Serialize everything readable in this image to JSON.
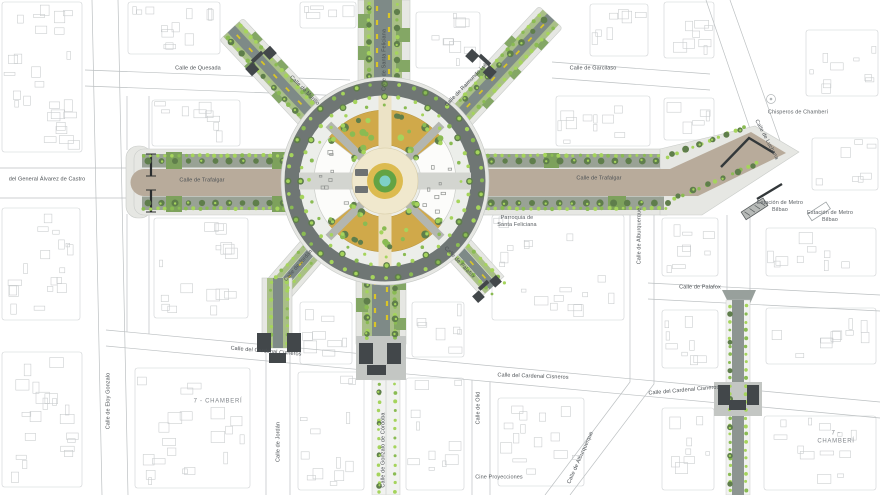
{
  "labels": {
    "quesada": "Calle de Quesada",
    "garcilaso": "Calle de Garcilaso",
    "chisperos": "Chisperos de Chamberí",
    "luchana": "Calle de Luchana",
    "alvarez_castro": "del General Álvarez de Castro",
    "trafalgar_w": "Calle de Trafalgar",
    "trafalgar_e": "Calle de Trafalgar",
    "metro_bilbao_1": "Estación de Metro\nBilbao",
    "metro_bilbao_2": "Estación de Metro\nBilbao",
    "parroquia": "Parroquia de\nSanta Feliciana",
    "murillo": "Calle de Murillo",
    "santa_feliciana": "Calle de Santa Feliciana",
    "raimundo_lulio": "Calle de Raimundo Lulio",
    "alburquerque_v": "Calle de Alburquerque",
    "alburquerque_diag": "Calle de Alburquerque",
    "palafox_h": "Calle de Palafox",
    "palafox_diag": "Calle de Palafox",
    "jordan_diag": "Calle de Jordán",
    "jordan_v": "Calle de Jordán",
    "cisneros_w": "Calle del Cardenal Cisneros",
    "cisneros_c": "Calle del Cardenal Cisneros",
    "cisneros_e": "Calle del Cardenal Cisneros",
    "chamberi_w": "7 - CHAMBERÍ",
    "chamberi_e": "7 - CHAMBERÍ",
    "eloy_gonzalo": "Calle de Eloy Gonzalo",
    "gonzalo_cordoba": "Calle de Gonzalo de Córdoba",
    "olid": "Calle de Olid",
    "cine": "Cine Proyecciones"
  },
  "colors": {
    "sidewalk": "#e6e7e3",
    "road_tan": "#b8ab9b",
    "band": "#99a295",
    "lane": "#7e8a87",
    "ring": "#6f7674",
    "island": "#7da15c",
    "strip": "#a9bf87",
    "bulge": "#84a765",
    "dot_light": "#a5d45c",
    "dot_mid": "#8abb53",
    "canopy": "#5f7e4b",
    "ochre": "#d0a94a",
    "cream": "#f0e8cd",
    "center_ring": "#dcbb50",
    "center_green": "#63a344",
    "teal": "#7ed0c8",
    "plaza_inner": "#eceeea",
    "white_sector": "#fcfcfa",
    "path_diag": "#b3b6b0",
    "gate": "#42474a",
    "yellow": "#d9c527"
  }
}
